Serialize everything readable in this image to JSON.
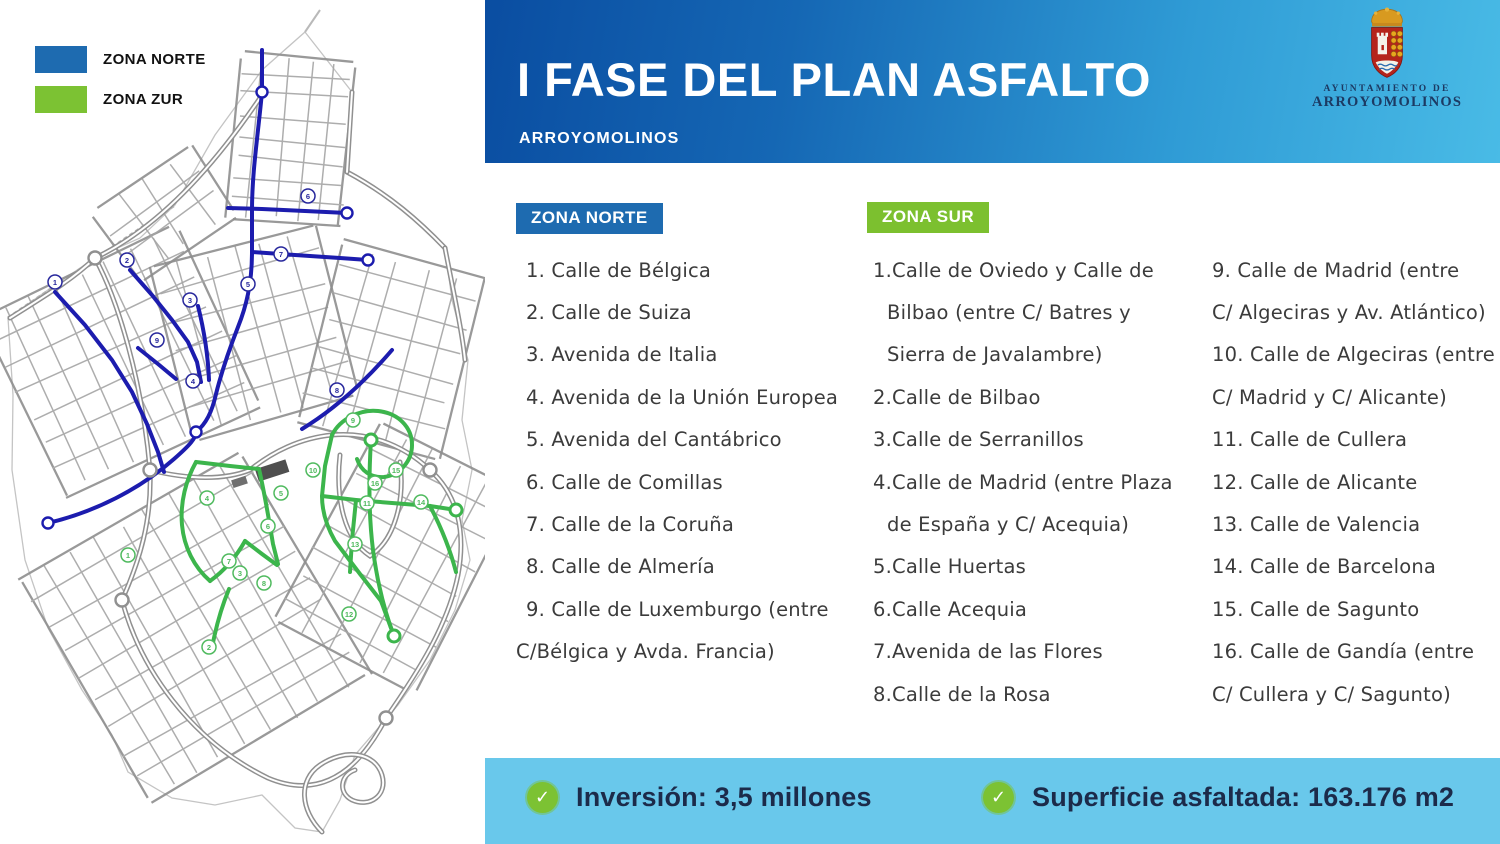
{
  "colors": {
    "north_blue": "#1e6bb0",
    "south_green": "#7cc233",
    "route_blue": "#1c1cae",
    "route_green": "#3cb54c",
    "footer_bg": "#69c8eb",
    "header_start": "#0a4da1",
    "header_end": "#49bbe6"
  },
  "legend": {
    "north_label": "ZONA NORTE",
    "south_label": "ZONA ZUR"
  },
  "header": {
    "title": "I FASE DEL PLAN ASFALTO",
    "subtitle": "ARROYOMOLINOS"
  },
  "logo": {
    "line1": "AYUNTAMIENTO DE",
    "line2": "ARROYOMOLINOS"
  },
  "zona_norte": {
    "label": "ZONA NORTE",
    "lines": [
      {
        "t": "1. Calle de Bélgica",
        "k": "item"
      },
      {
        "t": "2. Calle de Suiza",
        "k": "item"
      },
      {
        "t": "3. Avenida de Italia",
        "k": "item"
      },
      {
        "t": "4. Avenida de la Unión Europea",
        "k": "item"
      },
      {
        "t": "5. Avenida del Cantábrico",
        "k": "item"
      },
      {
        "t": "6. Calle de Comillas",
        "k": "item"
      },
      {
        "t": "7. Calle de la Coruña",
        "k": "item"
      },
      {
        "t": "8. Calle de Almería",
        "k": "item"
      },
      {
        "t": "9. Calle de Luxemburgo (entre",
        "k": "item"
      },
      {
        "t": "C/Bélgica y Avda. Francia)",
        "k": "cont"
      }
    ]
  },
  "zona_sur": {
    "label": "ZONA SUR",
    "col1": [
      {
        "t": "1.Calle de Oviedo y Calle de",
        "k": "item0"
      },
      {
        "t": "Bilbao (entre C/ Batres y",
        "k": "cont-in"
      },
      {
        "t": "Sierra de Javalambre)",
        "k": "cont-in"
      },
      {
        "t": "2.Calle de Bilbao",
        "k": "item0"
      },
      {
        "t": "3.Calle de Serranillos",
        "k": "item0"
      },
      {
        "t": "4.Calle de Madrid (entre Plaza",
        "k": "item0"
      },
      {
        "t": "de España y C/ Acequia)",
        "k": "cont-in"
      },
      {
        "t": "5.Calle Huertas",
        "k": "item0"
      },
      {
        "t": "6.Calle Acequia",
        "k": "item0"
      },
      {
        "t": "7.Avenida de las Flores",
        "k": "item0"
      },
      {
        "t": "8.Calle de la Rosa",
        "k": "item0"
      }
    ],
    "col2": [
      {
        "t": "9. Calle de Madrid (entre",
        "k": "item0"
      },
      {
        "t": "C/ Algeciras y Av. Atlántico)",
        "k": "cont"
      },
      {
        "t": "10. Calle de Algeciras (entre",
        "k": "item0"
      },
      {
        "t": "C/ Madrid y C/ Alicante)",
        "k": "cont"
      },
      {
        "t": "11. Calle de Cullera",
        "k": "item0"
      },
      {
        "t": "12. Calle de Alicante",
        "k": "item0"
      },
      {
        "t": "13. Calle de Valencia",
        "k": "item0"
      },
      {
        "t": "14. Calle de Barcelona",
        "k": "item0"
      },
      {
        "t": "15. Calle de Sagunto",
        "k": "item0"
      },
      {
        "t": "16. Calle de Gandía (entre",
        "k": "item0"
      },
      {
        "t": "C/ Cullera y C/ Sagunto)",
        "k": "cont"
      }
    ]
  },
  "footer": {
    "stat1": "Inversión: 3,5 millones",
    "stat2": "Superficie asfaltada: 163.176 m2"
  },
  "map": {
    "markers_north": [
      {
        "n": "1",
        "x": 55,
        "y": 282
      },
      {
        "n": "2",
        "x": 127,
        "y": 260
      },
      {
        "n": "3",
        "x": 190,
        "y": 300
      },
      {
        "n": "4",
        "x": 193,
        "y": 381
      },
      {
        "n": "5",
        "x": 248,
        "y": 284
      },
      {
        "n": "6",
        "x": 308,
        "y": 196
      },
      {
        "n": "7",
        "x": 281,
        "y": 254
      },
      {
        "n": "8",
        "x": 337,
        "y": 390
      },
      {
        "n": "9",
        "x": 157,
        "y": 340
      }
    ],
    "markers_south": [
      {
        "n": "1",
        "x": 128,
        "y": 555
      },
      {
        "n": "2",
        "x": 209,
        "y": 647
      },
      {
        "n": "3",
        "x": 240,
        "y": 573
      },
      {
        "n": "4",
        "x": 207,
        "y": 498
      },
      {
        "n": "5",
        "x": 281,
        "y": 493
      },
      {
        "n": "6",
        "x": 268,
        "y": 526
      },
      {
        "n": "7",
        "x": 229,
        "y": 561
      },
      {
        "n": "8",
        "x": 264,
        "y": 583
      },
      {
        "n": "9",
        "x": 353,
        "y": 420
      },
      {
        "n": "10",
        "x": 313,
        "y": 470
      },
      {
        "n": "11",
        "x": 367,
        "y": 503
      },
      {
        "n": "12",
        "x": 349,
        "y": 614
      },
      {
        "n": "13",
        "x": 355,
        "y": 544
      },
      {
        "n": "14",
        "x": 421,
        "y": 502
      },
      {
        "n": "15",
        "x": 396,
        "y": 470
      },
      {
        "n": "16",
        "x": 375,
        "y": 483
      }
    ]
  }
}
